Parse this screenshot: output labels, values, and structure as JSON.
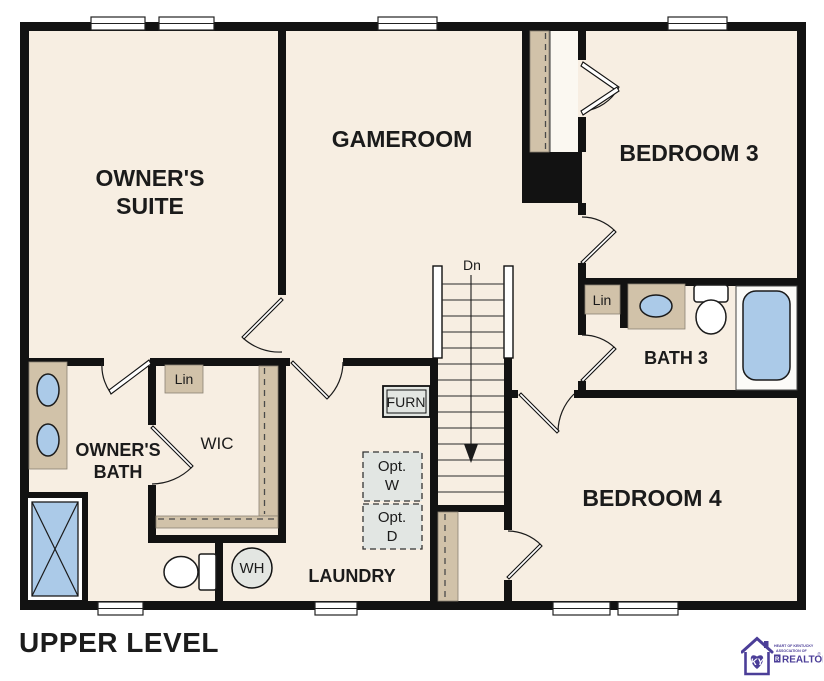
{
  "title": "UPPER LEVEL",
  "colors": {
    "floor": "#f7eee2",
    "wall": "#121212",
    "shelf_tan": "#d1c2a9",
    "fixture_blue": "#abcae8",
    "equipment_gray": "#e3e6e2",
    "logo_purple": "#4b3e98"
  },
  "rooms": {
    "owners_suite": {
      "line1": "OWNER'S",
      "line2": "SUITE"
    },
    "gameroom": {
      "label": "GAMEROOM"
    },
    "bedroom3": {
      "label": "BEDROOM 3"
    },
    "bath3": {
      "label": "BATH 3",
      "linen": "Lin"
    },
    "bedroom4": {
      "label": "BEDROOM 4"
    },
    "laundry": {
      "label": "LAUNDRY"
    },
    "owners_bath": {
      "line1": "OWNER'S",
      "line2": "BATH",
      "linen": "Lin"
    },
    "wic": {
      "label": "WIC"
    }
  },
  "stairs": {
    "direction_label": "Dn"
  },
  "equipment": {
    "furnace": "FURN",
    "optional_washer": {
      "line1": "Opt.",
      "line2": "W"
    },
    "optional_dryer": {
      "line1": "Opt.",
      "line2": "D"
    },
    "water_heater": "WH"
  },
  "logo": {
    "monogram": "KY",
    "line1": "HEART OF KENTUCKY",
    "line2": "ASSOCIATION OF",
    "realtor_r": "R",
    "name": "REALTORS",
    "registered": "®"
  }
}
